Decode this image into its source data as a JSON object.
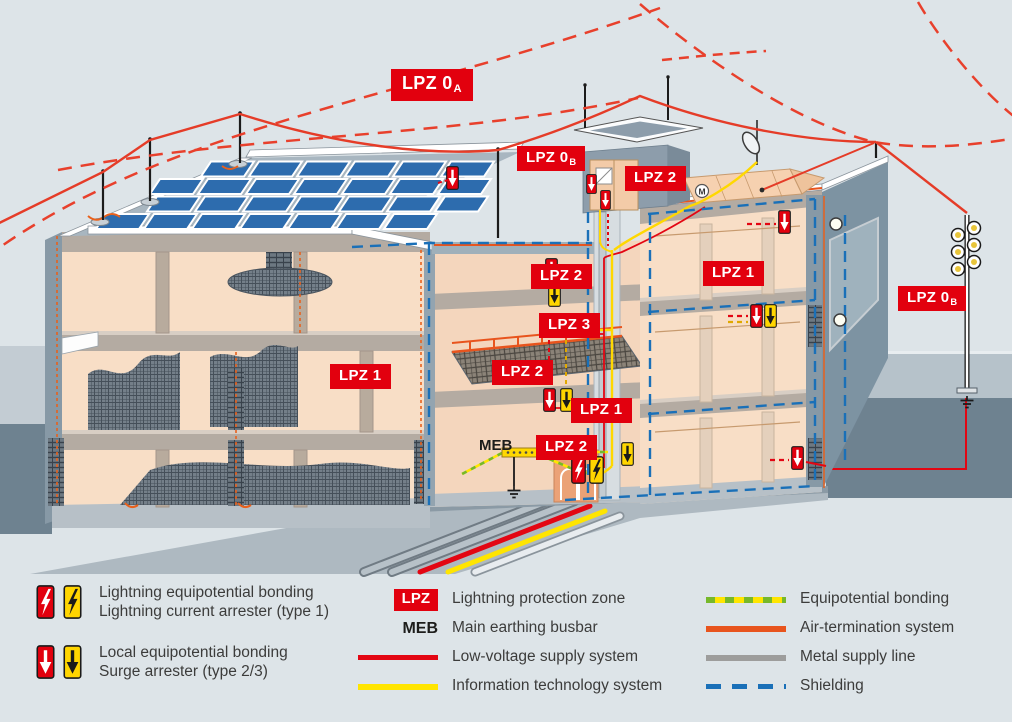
{
  "colors": {
    "background": "#dde4e8",
    "zone_badge_red": "#e2000e",
    "low_voltage_red": "#e30613",
    "it_yellow": "#ffe500",
    "equipotential_green": "#76b82a",
    "air_termination_orange": "#e8541d",
    "metal_gray": "#9d9d9c",
    "shielding_blue": "#1a70b8",
    "arrester_yellow": "#ffd500",
    "solar_panel_blue": "#2d6cae"
  },
  "diagram": {
    "zone_labels": [
      {
        "text": "LPZ 0",
        "sub": "A"
      },
      {
        "text": "LPZ 0",
        "sub": "B"
      },
      {
        "text": "LPZ 2",
        "sub": ""
      },
      {
        "text": "LPZ 2",
        "sub": ""
      },
      {
        "text": "LPZ 1",
        "sub": ""
      },
      {
        "text": "LPZ 0",
        "sub": "B"
      },
      {
        "text": "LPZ 3",
        "sub": ""
      },
      {
        "text": "LPZ 2",
        "sub": ""
      },
      {
        "text": "LPZ 1",
        "sub": ""
      },
      {
        "text": "LPZ 1",
        "sub": ""
      },
      {
        "text": "LPZ 2",
        "sub": ""
      }
    ],
    "meb_label": "MEB",
    "motor_label": "M"
  },
  "legend": {
    "arresters": [
      {
        "line1": "Lightning equipotential bonding",
        "line2": "Lightning current arrester (type 1)"
      },
      {
        "line1": "Local equipotential bonding",
        "line2": "Surge arrester (type 2/3)"
      }
    ],
    "abbrevs": [
      {
        "key": "LPZ",
        "label": "Lightning protection zone"
      },
      {
        "key": "MEB",
        "label": "Main earthing busbar"
      }
    ],
    "supply_lines": [
      {
        "label": "Low-voltage supply system"
      },
      {
        "label": "Information technology system"
      }
    ],
    "system_lines": [
      {
        "label": "Equipotential bonding"
      },
      {
        "label": "Air-termination system"
      },
      {
        "label": "Metal supply line"
      },
      {
        "label": "Shielding"
      }
    ]
  }
}
